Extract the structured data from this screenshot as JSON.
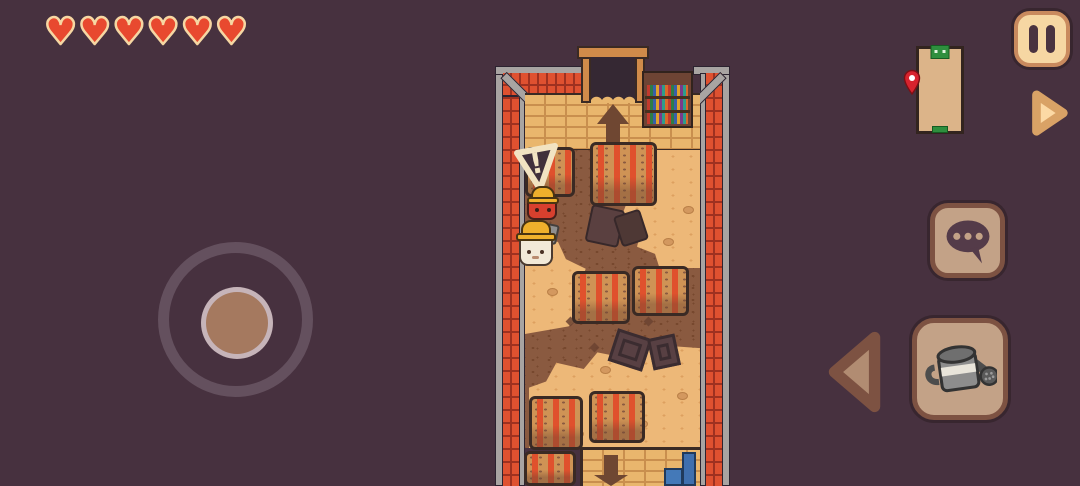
{
  "hud": {
    "health": {
      "hearts": 6,
      "heart_glyph": "♥",
      "heart_fill": "#e8492f",
      "heart_outline": "#f6d7a3"
    },
    "pause_button": {
      "icon": "pause-icon"
    },
    "minimap": {
      "room_fill": "#dcb489",
      "border_color": "#33241f",
      "exit_top_color": "#2e8f3e",
      "exit_bottom_color": "#2e8f3e",
      "player_pin_color": "#d8232e"
    },
    "next_button": {
      "icon": "arrow-right-icon",
      "fill": "#fcd9a5",
      "stroke": "#d9a266"
    },
    "prev_button": {
      "icon": "arrow-left-icon",
      "fill": "#b18c72",
      "stroke": "#7d5242"
    },
    "chat_button": {
      "icon": "speech-bubble-icon",
      "bubble_fill": "#543b49",
      "dot_count": 3
    },
    "tool_button": {
      "icon": "watering-can-icon"
    },
    "joystick": {
      "knob_fill": "#a5795f"
    }
  },
  "scene": {
    "warning_sign": {
      "symbol": "!",
      "fill": "#41303c",
      "outline": "#f2e3c2"
    },
    "npc": {
      "body_color": "#d8402e",
      "hat_color": "#efb02c"
    },
    "player": {
      "body_color": "#f2e9d8",
      "hat_color": "#efb02c"
    },
    "crop_bed_count": 7,
    "palette": {
      "background": "#47313f",
      "brick_red": "#df5130",
      "brick_red_mortar": "#9e3120",
      "wall_tan": "#e9b66d",
      "wall_tan_mortar": "#c98f4e",
      "dirt": "#8a5a40",
      "dirt_speckle": "#77482e",
      "sand": "#edb878",
      "sand_speckle": "#dda05f",
      "rail_gray": "#a8a4a2",
      "crop_stripe": "#e0512d",
      "crop_soil": "#cf9355",
      "outline_dark": "#3a2a24",
      "arrow_shadow": "#6f4732",
      "debris": "#5a4040"
    }
  }
}
